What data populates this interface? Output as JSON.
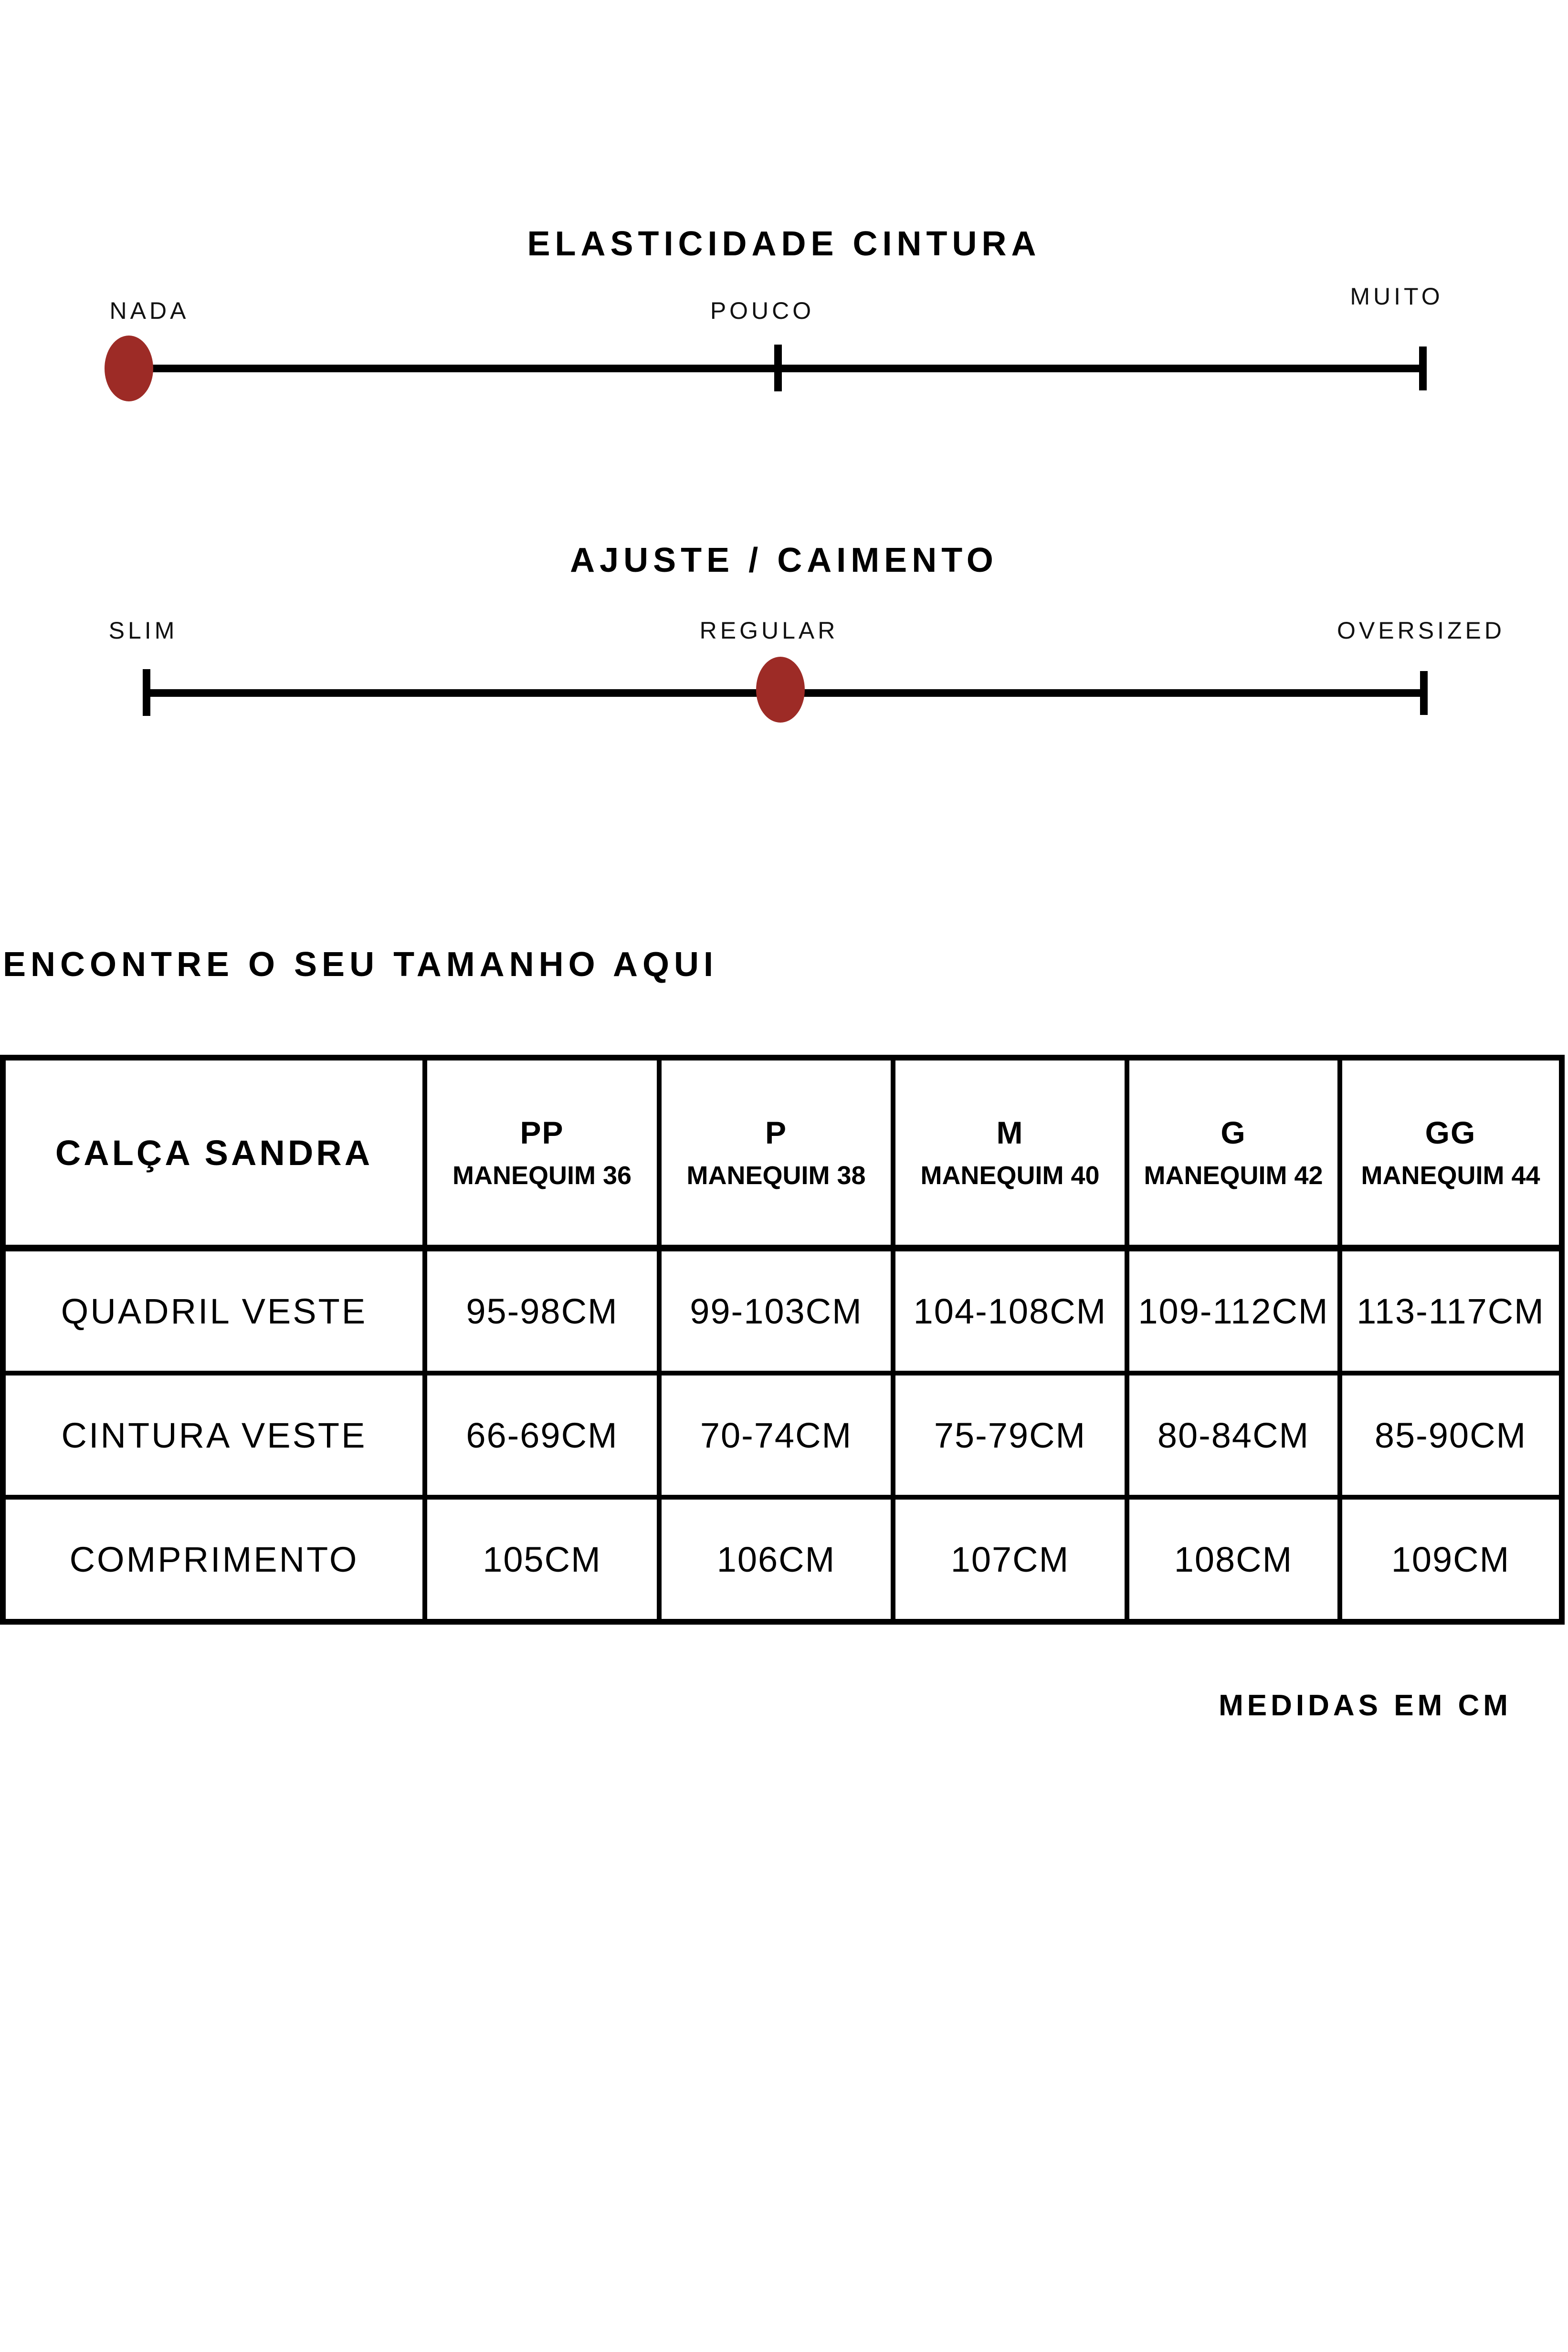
{
  "colors": {
    "background": "#FFFFFF",
    "ink": "#000000",
    "marker_red": "#9D2B26"
  },
  "elasticity": {
    "title": "ELASTICIDADE CINTURA",
    "left_label": "NADA",
    "center_label": "POUCO",
    "right_label": "MUITO",
    "selected_level": "NADA"
  },
  "fit": {
    "title": "AJUSTE / CAIMENTO",
    "left_label": "SLIM",
    "center_label": "REGULAR",
    "right_label": "OVERSIZED",
    "selected_level": "REGULAR"
  },
  "size_guide": {
    "heading": "ENCONTRE O SEU TAMANHO AQUI",
    "product_name": "CALÇA SANDRA",
    "sizes": [
      {
        "size": "PP",
        "mannequin": "MANEQUIM 36"
      },
      {
        "size": "P",
        "mannequin": "MANEQUIM 38"
      },
      {
        "size": "M",
        "mannequin": "MANEQUIM 40"
      },
      {
        "size": "G",
        "mannequin": "MANEQUIM 42"
      },
      {
        "size": "GG",
        "mannequin": "MANEQUIM 44"
      }
    ],
    "measurements": [
      {
        "label": "QUADRIL VESTE",
        "values": [
          "95-98CM",
          "99-103CM",
          "104-108CM",
          "109-112CM",
          "113-117CM"
        ]
      },
      {
        "label": "CINTURA VESTE",
        "values": [
          "66-69CM",
          "70-74CM",
          "75-79CM",
          "80-84CM",
          "85-90CM"
        ]
      },
      {
        "label": "COMPRIMENTO",
        "values": [
          "105CM",
          "106CM",
          "107CM",
          "108CM",
          "109CM"
        ]
      }
    ],
    "footnote": "MEDIDAS EM CM"
  },
  "chart_data": {
    "type": "table",
    "title": "CALÇA SANDRA",
    "columns": [
      "PP MANEQUIM 36",
      "P MANEQUIM 38",
      "M MANEQUIM 40",
      "G MANEQUIM 42",
      "GG MANEQUIM 44"
    ],
    "rows": [
      [
        "QUADRIL VESTE",
        "95-98CM",
        "99-103CM",
        "104-108CM",
        "109-112CM",
        "113-117CM"
      ],
      [
        "CINTURA VESTE",
        "66-69CM",
        "70-74CM",
        "75-79CM",
        "80-84CM",
        "85-90CM"
      ],
      [
        "COMPRIMENTO",
        "105CM",
        "106CM",
        "107CM",
        "108CM",
        "109CM"
      ]
    ]
  }
}
